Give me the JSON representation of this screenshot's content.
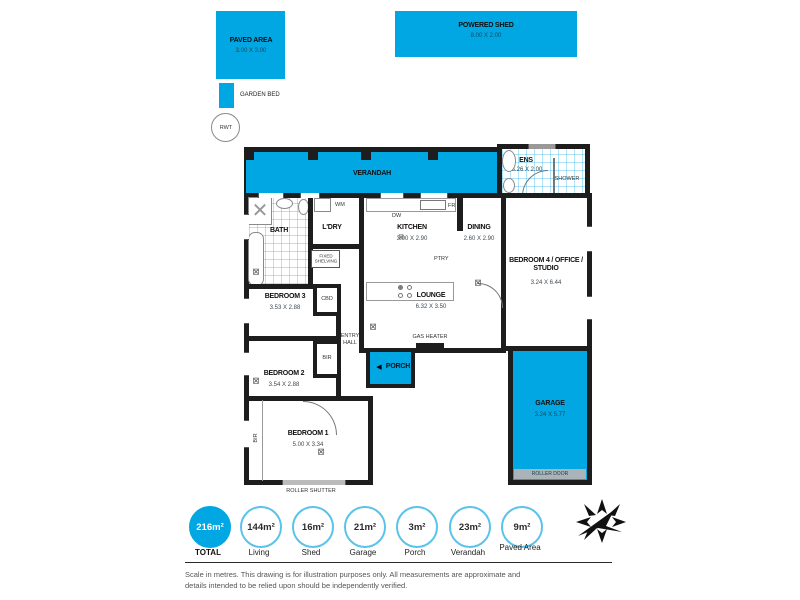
{
  "colors": {
    "accent": "#00a7e3",
    "wall": "#1d1d1d"
  },
  "outdoor": {
    "paved_area": {
      "name": "PAVED AREA",
      "dims": "3.00 X 3.00"
    },
    "powered_shed": {
      "name": "POWERED SHED",
      "dims": "8.00 X 2.00"
    },
    "garden_bed": {
      "label": "GARDEN BED"
    },
    "rwt": {
      "label": "RWT"
    }
  },
  "rooms": {
    "verandah": {
      "name": "VERANDAH"
    },
    "ens": {
      "name": "ENS",
      "dims": "3.26 X 2.00",
      "shower": "SHOWER"
    },
    "bath": {
      "name": "BATH"
    },
    "laundry": {
      "name": "L'DRY",
      "wm": "WM",
      "fixed_shelving": "FIXED SHELVING"
    },
    "kitchen": {
      "name": "KITCHEN",
      "dims": "3.00 X 2.90",
      "dw": "DW",
      "fr": "FR",
      "ptry": "PTRY"
    },
    "dining": {
      "name": "DINING",
      "dims": "2.60 X 2.90"
    },
    "lounge": {
      "name": "LOUNGE",
      "dims": "6.32 X 3.50",
      "gas_heater": "GAS HEATER"
    },
    "entry_hall": {
      "name": "ENTRY HALL"
    },
    "porch": {
      "name": "PORCH"
    },
    "bedroom1": {
      "name": "BEDROOM 1",
      "dims": "5.00 X 3.34",
      "bir": "BIR",
      "roller_shutter": "ROLLER SHUTTER"
    },
    "bedroom2": {
      "name": "BEDROOM 2",
      "dims": "3.54 X 2.88",
      "bir": "BIR"
    },
    "bedroom3": {
      "name": "BEDROOM 3",
      "dims": "3.53 X 2.88",
      "cbd": "CBD"
    },
    "bedroom4": {
      "name": "BEDROOM 4 / OFFICE / STUDIO",
      "dims": "3.24 X 6.44"
    },
    "garage": {
      "name": "GARAGE",
      "dims": "3.24 X 5.77",
      "roller_door": "ROLLER DOOR"
    }
  },
  "legend": {
    "items": [
      {
        "value": "216m²",
        "label": "TOTAL",
        "filled": true
      },
      {
        "value": "144m²",
        "label": "Living",
        "filled": false
      },
      {
        "value": "16m²",
        "label": "Shed",
        "filled": false
      },
      {
        "value": "21m²",
        "label": "Garage",
        "filled": false
      },
      {
        "value": "3m²",
        "label": "Porch",
        "filled": false
      },
      {
        "value": "23m²",
        "label": "Verandah",
        "filled": false
      },
      {
        "value": "9m²",
        "label": "Paved Area",
        "filled": false
      }
    ]
  },
  "disclaimer": "Scale in metres. This drawing is for illustration purposes only. All measurements are approximate and details intended to be relied upon should be independently verified."
}
